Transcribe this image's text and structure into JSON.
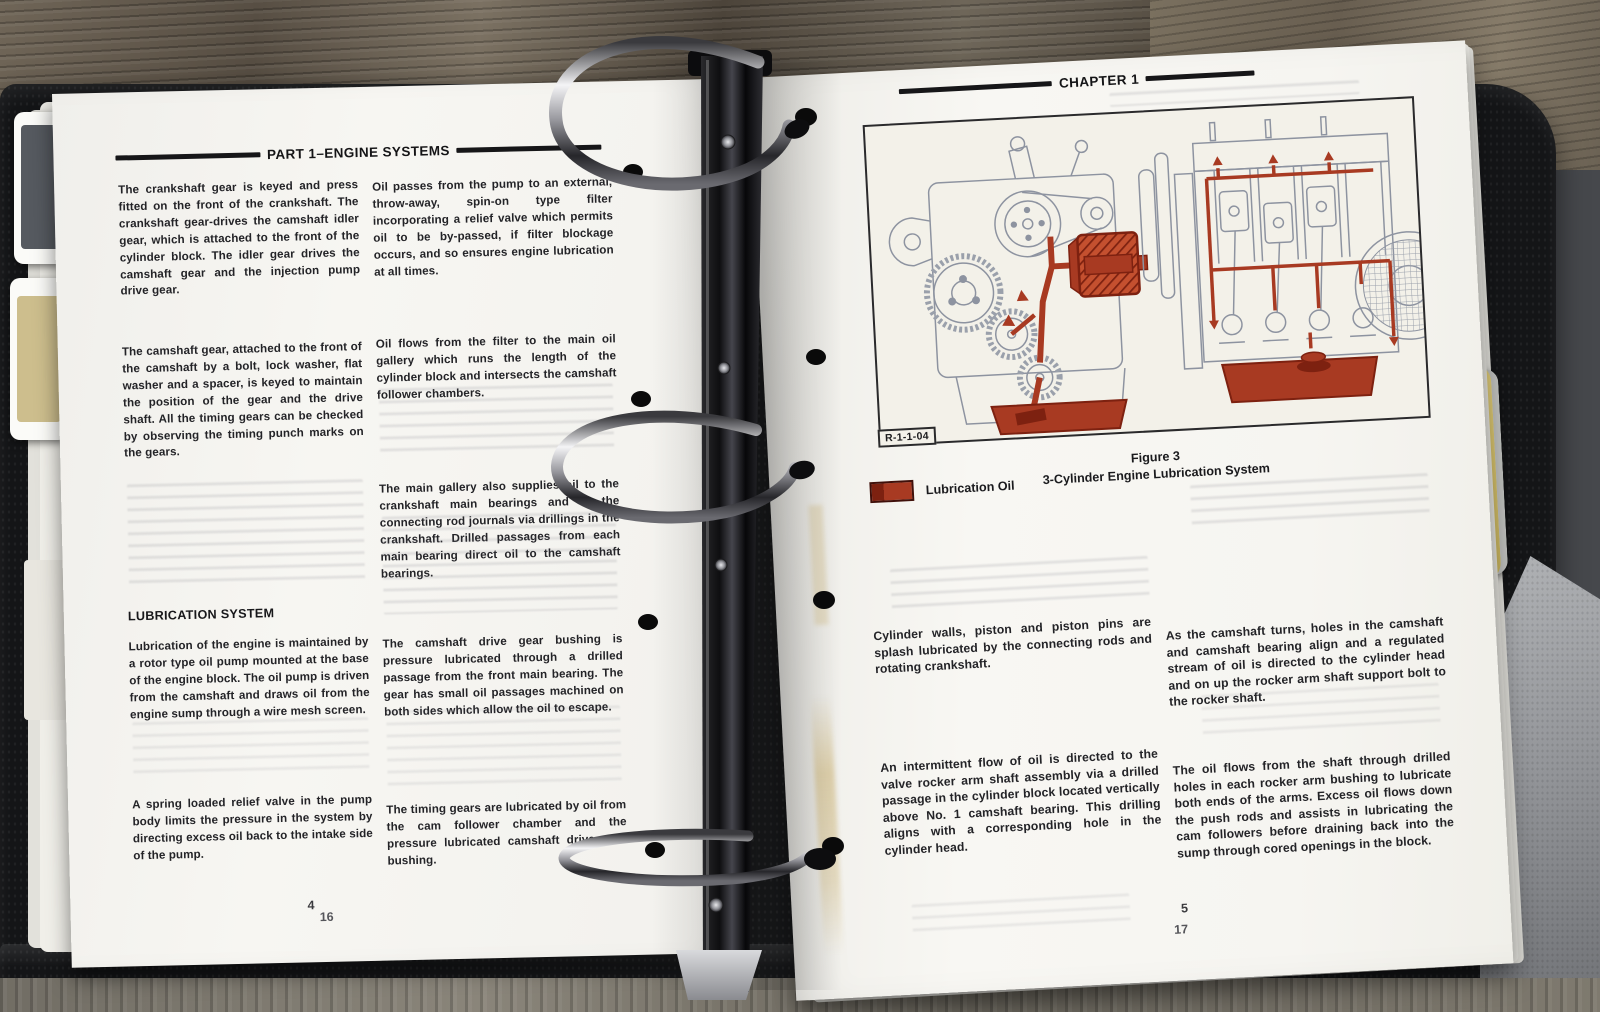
{
  "left_page": {
    "header": "PART 1–ENGINE SYSTEMS",
    "col1_para1": "The crankshaft gear is keyed and press fitted on the front of the crankshaft. The crankshaft gear-drives the camshaft idler gear, which is attached to the front of the cylinder block. The idler gear drives the camshaft gear and the injection pump drive gear.",
    "col1_para2": "The camshaft gear, attached to the front of the camshaft by a bolt, lock washer, flat washer and a spacer, is keyed to maintain the position of the gear and the drive shaft. All the timing gears can be checked by observing the timing punch marks on the gears.",
    "section_heading": "LUBRICATION SYSTEM",
    "col1_para3": "Lubrication of the engine is maintained by a rotor type oil pump mounted at the base of the engine block. The oil pump is driven from the camshaft and draws oil from the engine sump through a wire mesh screen.",
    "col1_para4": "A spring loaded relief valve in the pump body limits the pressure in the system by directing excess oil back to the intake side of the pump.",
    "col2_para1": "Oil passes from the pump to an external, throw-away, spin-on type filter incorporating a relief valve which permits oil to be by-passed, if filter blockage occurs, and so ensures engine lubrication at all times.",
    "col2_para2": "Oil flows from the filter to the main oil gallery which runs the length of the cylinder block and intersects the camshaft follower chambers.",
    "col2_para3": "The main gallery also supplies oil to the crankshaft main bearings and to the connecting rod journals via drillings in the crankshaft. Drilled passages from each main bearing direct oil to the camshaft bearings.",
    "col2_para4": "The camshaft drive gear bushing is pressure lubricated through a drilled passage from the front main bearing. The gear has small oil passages machined on both sides which allow the oil to escape.",
    "col2_para5": "The timing gears are lubricated by oil from the cam follower chamber and the pressure lubricated camshaft drive gear bushing.",
    "page_number_top": "4",
    "page_number_bottom": "16"
  },
  "right_page": {
    "header": "CHAPTER 1",
    "figure": {
      "ref_code": "R-1-1-04",
      "label": "Figure 3",
      "caption": "3-Cylinder Engine Lubrication System"
    },
    "legend": {
      "label": "Lubrication Oil",
      "color": "#a83a22"
    },
    "col1_para1": "Cylinder walls, piston and piston pins are splash lubricated by the connecting rods and rotating crankshaft.",
    "col1_para2": "An intermittent flow of oil is directed to the valve rocker arm shaft assembly via a drilled passage in the cylinder block located vertically above No. 1 camshaft bearing. This drilling aligns with a corresponding hole in the cylinder head.",
    "col2_para1": "As the camshaft turns, holes in the camshaft and camshaft bearing align and a regulated stream of oil is directed to the cylinder head and on up the rocker arm shaft support bolt to the rocker shaft.",
    "col2_para2": "The oil flows from the shaft through drilled holes in each rocker arm bushing to lubricate both ends of the arms. Excess oil flows down the push rods and assists in lubricating the cam followers before draining back into the sump through cored openings in the block.",
    "page_number_top": "5",
    "page_number_bottom": "17"
  }
}
